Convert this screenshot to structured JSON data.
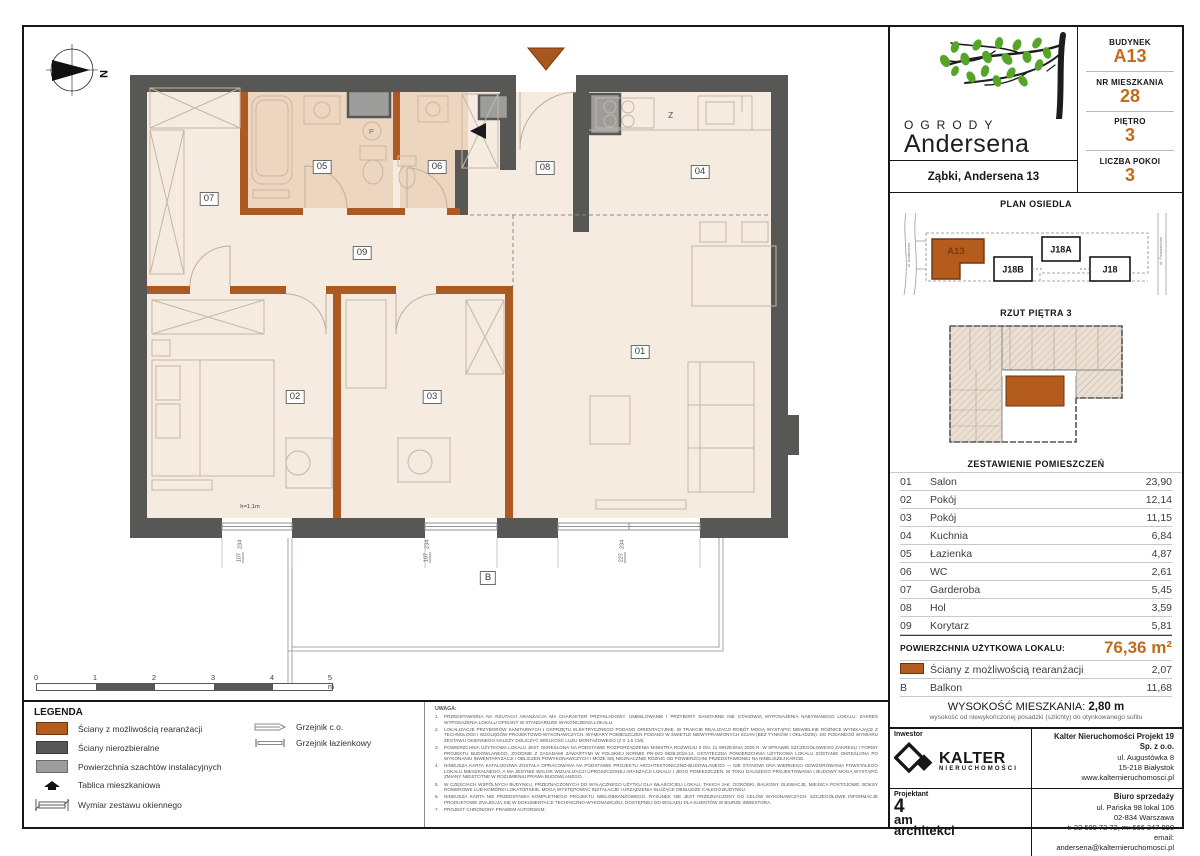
{
  "info_panel": {
    "budynek_label": "BUDYNEK",
    "budynek": "A13",
    "nr_label": "NR MIESZKANIA",
    "nr": "28",
    "pietro_label": "PIĘTRO",
    "pietro": "3",
    "pokoi_label": "LICZBA POKOI",
    "pokoi": "3"
  },
  "brand": {
    "title_line1": "OGRODY",
    "title_line2": "Andersena",
    "address": "Ząbki, Andersena 13"
  },
  "site_plan": {
    "title": "PLAN OSIEDLA",
    "buildings": {
      "a13": "A13",
      "j18b": "J18B",
      "j18a": "J18A",
      "j18": "J18"
    },
    "street_left": "ul. Andersena",
    "street_right": "ul. Powstańców"
  },
  "floor_overview": {
    "title": "RZUT PIĘTRA 3"
  },
  "rooms_table": {
    "title": "ZESTAWIENIE POMIESZCZEŃ",
    "rows": [
      {
        "no": "01",
        "name": "Salon",
        "area": "23,90"
      },
      {
        "no": "02",
        "name": "Pokój",
        "area": "12,14"
      },
      {
        "no": "03",
        "name": "Pokój",
        "area": "11,15"
      },
      {
        "no": "04",
        "name": "Kuchnia",
        "area": "6,84"
      },
      {
        "no": "05",
        "name": "Łazienka",
        "area": "4,87"
      },
      {
        "no": "06",
        "name": "WC",
        "area": "2,61"
      },
      {
        "no": "07",
        "name": "Garderoba",
        "area": "5,45"
      },
      {
        "no": "08",
        "name": "Hol",
        "area": "3,59"
      },
      {
        "no": "09",
        "name": "Korytarz",
        "area": "5,81"
      }
    ],
    "total_label": "POWIERZCHNIA UŻYTKOWA LOKALU:",
    "total_value": "76,36 m²",
    "extra_rows": [
      {
        "no": "swatch",
        "name": "Ściany z możliwością rearanżacji",
        "area": "2,07"
      },
      {
        "no": "B",
        "name": "Balkon",
        "area": "11,68"
      }
    ]
  },
  "height_note": {
    "label": "WYSOKOŚĆ MIESZKANIA:",
    "value": "2,80 m",
    "note": "wysokość od niewykończonej posadzki (szlichty) do otynkowanego sufitu"
  },
  "footer": {
    "inwestor_label": "Inwestor",
    "projektant_label": "Projektant",
    "kalter_name": "KALTER",
    "kalter_sub": "NIERUCHOMOŚCI",
    "company": "Kalter Nieruchomości Projekt 19 Sp. z o.o.",
    "company_lines": [
      "ul. Augustówka 8",
      "15-218 Białystok",
      "www.kalternieruchomosci.pl"
    ],
    "biuro_label": "Biuro sprzedaży",
    "biuro_lines": [
      "ul. Pańska 98 lokal 106",
      "02-834 Warszawa",
      "t: 22 509 72 72, m: 666 347 990",
      "email: andersena@kalternieruchomosci.pl"
    ],
    "architect_1": "4",
    "architect_2": "am",
    "architect_3": "architekci"
  },
  "legend": {
    "title": "LEGENDA",
    "items_left": [
      {
        "icon": "swatch-orange",
        "label": "Ściany z możliwością rearanżacji"
      },
      {
        "icon": "swatch-dark",
        "label": "Ściany nierozbieralne"
      },
      {
        "icon": "swatch-gray",
        "label": "Powierzchnia szachtów instalacyjnych"
      },
      {
        "icon": "tablica",
        "label": "Tablica mieszkaniowa"
      },
      {
        "icon": "window-dim",
        "label": "Wymiar zestawu okiennego"
      }
    ],
    "items_right": [
      {
        "icon": "grzejnik-co",
        "label": "Grzejnik c.o."
      },
      {
        "icon": "grzejnik-laz",
        "label": "Grzejnik łazienkowy"
      }
    ]
  },
  "scale_bar": {
    "ticks": [
      "0",
      "1",
      "2",
      "3",
      "4",
      "5 m"
    ]
  },
  "uwaga": {
    "title": "UWAGA:",
    "lines": [
      {
        "n": "1.",
        "t": "PRZEDSTAWIONA NA RZUTACH ARANŻACJA MA CHARAKTER PRZYKŁADOWY. UMEBLOWANIE I PRZYBORY SANITARNE NIE STANOWIĄ WYPOSAŻENIA NABYWANEGO LOKALU. ZAKRES WYPOSAŻENIA LOKALU OPISANY W STANDARDZIE WYKOŃCZENIA LOKALU."
      },
      {
        "n": "2.",
        "t": "LOKALIZACJE PRZYBORÓW SANITARNYCH I OSPRZĘTU ELEKTRYCZNEGO PODANO ORIENTACYJNIE. W TRAKCIE REALIZACJI ROBÓT MOGĄ WYSTĄPIĆ NIEWIELKIE RÓŻNICE WYNIKAJĄCE Z TECHNOLOGII I WZGLĘDÓW PROJEKTOWO-WYKONAWCZYCH. WYMIARY POMIESZCZEŃ PODANO W ŚWIETLE NIEWYPRAWIONYCH ŚCIAN (BEZ TYNKÓW I OKŁADZIN). DO PODANEGO WYMIARU ZESTAWU OKIENNEGO NALEŻY DOLICZYĆ WIELKOŚĆ LUZU MONTAŻOWEGO (2 X 1,5 CM)."
      },
      {
        "n": "3.",
        "t": "POWIERZCHNIA UŻYTKOWA LOKALU JEST OKREŚLONA NA PODSTAWIE ROZPORZĄDZENIA MINISTRA ROZWOJU Z DN. 11 WRZEŚNIA 2020 R. W SPRAWIE SZCZEGÓŁOWEGO ZAKRESU I FORMY PROJEKTU BUDOWLANEGO, ZGODNIE Z ZASADAMI ZAWARTYMI W POLSKIEJ NORMIE PN-ISO 9836:2015-12. OSTATECZNA POWIERZCHNIA UŻYTKOWA LOKALU ZOSTANIE OKREŚLONA PO WYKONANIU INWENTARYZACJI I OBLICZEŃ POWYKONAWCZYCH I MOŻE SIĘ NIEZNACZNIE RÓŻNIĆ OD POWIERZCHNI PRZEDSTAWIONEJ NA NINIEJSZEJ KARCIE."
      },
      {
        "n": "4.",
        "t": "NINIEJSZA KARTA KATALOGOWA ZOSTAŁA OPRACOWANA NA PODSTAWIE PROJEKTU ARCHITEKTONICZNO-BUDOWLANEGO — NIE STANOWI ONA WIERNEGO ODWZOROWANIA POWSTAŁEGO LOKALU MIESZKALNEGO, A MA JEDYNIE WALOR WIZUALIZACJI UPROSZCZONEJ ARANŻACJI LOKALU I JEGO POMIESZCZEŃ. W TOKU DALSZEGO PROJEKTOWANIA I BUDOWY MOGĄ WYSTĄPIĆ ZMIANY NIEISTOTNE W ROZUMIENIU PRAWA BUDOWLANEGO."
      },
      {
        "n": "5.",
        "t": "W CZĘŚCIACH WSPÓLNYCH BUDYNKU, PRZEZNACZONYCH DO WYŁĄCZNEGO UŻYTKU DLA WŁAŚCICIELI LOKALI, TAKICH JAK: OGRÓDKI, BALKONY, ELEWACJE, MIEJSCA POSTOJOWE, BOKSY ROWEROWE LUB KOMÓRKI LOKATORSKIE, MOGĄ WYSTĘPOWAĆ INSTALACJE I URZĄDZENIA SŁUŻĄCE OBSŁUDZE CAŁEGO BUDYNKU."
      },
      {
        "n": "6.",
        "t": "NINIEJSZA KARTA NIE PRZEDSTAWIA KOMPLETNEGO PROJEKTU WIELOBRANŻOWEGO. RYSUNEK NIE JEST PRZEZNACZONY DO CELÓW WYKONAWCZYCH. SZCZEGÓŁOWE INFORMACJE PRODUKTOWE ZNAJDUJĄ SIĘ W DOKUMENTACJI TECHNICZNO-WYKONAWCZEJ, DOSTĘPNEJ DO WGLĄDU DLA KLIENTÓW W BIURZE INWESTORA."
      },
      {
        "n": "7.",
        "t": "PROJEKT CHRONIONY PRAWEM AUTORSKIM."
      }
    ]
  },
  "plan": {
    "north": "N",
    "kitchen_sink_label": "z",
    "washer_label": "P",
    "balcony_label": "B",
    "window_note": "h=1,1m",
    "room_labels": [
      {
        "no": "01",
        "x": 640,
        "y": 352
      },
      {
        "no": "02",
        "x": 295,
        "y": 397
      },
      {
        "no": "03",
        "x": 432,
        "y": 397
      },
      {
        "no": "04",
        "x": 700,
        "y": 172
      },
      {
        "no": "05",
        "x": 322,
        "y": 167
      },
      {
        "no": "06",
        "x": 437,
        "y": 167
      },
      {
        "no": "07",
        "x": 209,
        "y": 199
      },
      {
        "no": "08",
        "x": 545,
        "y": 168
      },
      {
        "no": "09",
        "x": 362,
        "y": 253
      }
    ],
    "balcony_pos": {
      "x": 488,
      "y": 578
    },
    "window_note_pos": {
      "x": 250,
      "y": 507
    },
    "dims": [
      {
        "top": "107",
        "bottom": "234",
        "x": 240,
        "y": 551
      },
      {
        "top": "107",
        "bottom": "234",
        "x": 427,
        "y": 551
      },
      {
        "top": "227",
        "bottom": "234",
        "x": 622,
        "y": 551
      }
    ]
  },
  "colors": {
    "accent_orange": "#c06b1e",
    "wall_orange": "#ad5a22",
    "wall_dark": "#575756",
    "shaft_gray": "#9d9d9c",
    "floor_beige": "#f5ebe1",
    "bath_tan": "#edd6bf",
    "leaf_green": "#56a528"
  }
}
